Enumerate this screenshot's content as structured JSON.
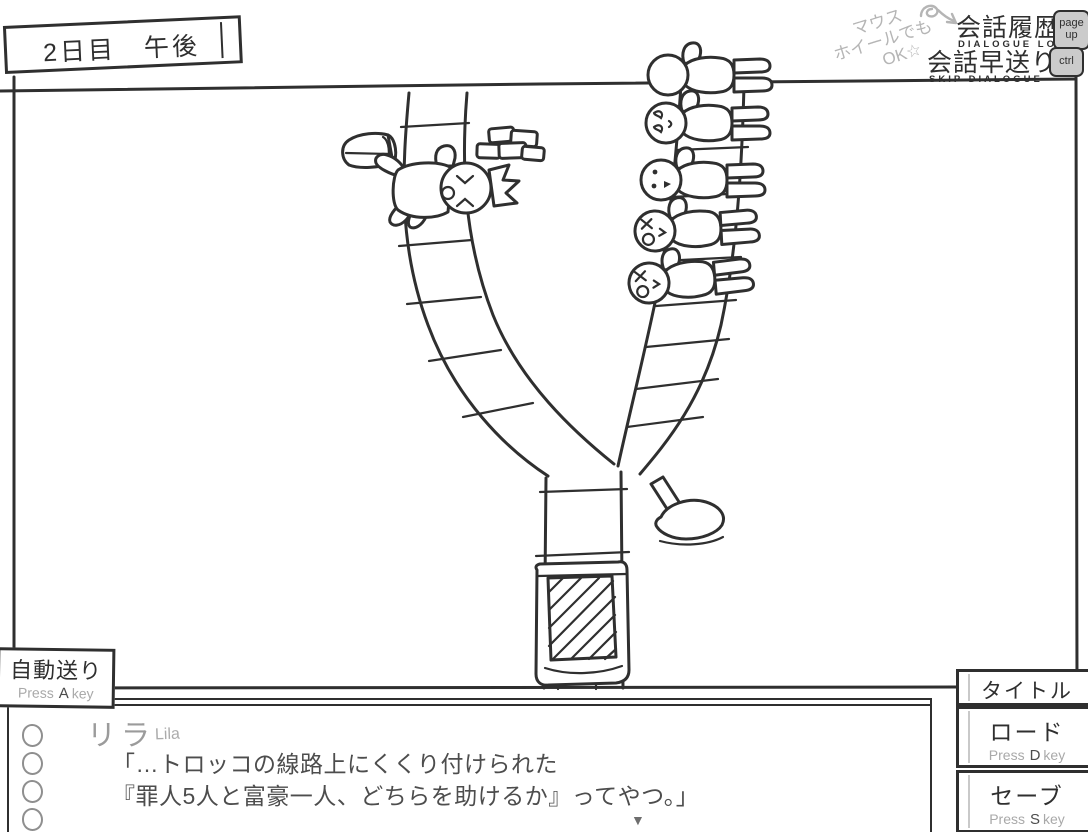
{
  "scene": {
    "banner": "2日目　午後",
    "advance_icon": "▼"
  },
  "shortcuts": {
    "note_lines": [
      "マウス",
      "ホイールでも",
      "OK☆"
    ],
    "log": {
      "label": "会話履歴",
      "sub": "DIALOGUE LOG",
      "key_line1": "page",
      "key_line2": "up"
    },
    "skip": {
      "label": "会話早送り",
      "sub": "SKIP DIALOGUE",
      "key": "ctrl"
    }
  },
  "auto_advance": {
    "label": "自動送り",
    "press_pre": "Press",
    "press_key": "A",
    "press_post": "key"
  },
  "menu": {
    "title": {
      "label": "タイトル"
    },
    "load": {
      "label": "ロード",
      "press_pre": "Press",
      "press_key": "D",
      "press_post": "key"
    },
    "save": {
      "label": "セーブ",
      "press_pre": "Press",
      "press_key": "S",
      "press_post": "key"
    }
  },
  "dialogue": {
    "speaker": "リラ",
    "speaker_en": "Lila",
    "lines": [
      "「…トロッコの線路上にくくり付けられた",
      "『罪人5人と富豪一人、どちらを助けるか』ってやつ。」"
    ]
  },
  "illustration": {
    "description_icons": [
      "trolley-icon",
      "switch-lever-icon",
      "treasure-chest-icon",
      "gold-bars-icon",
      "rich-person-icon",
      "five-sinners-icon"
    ]
  },
  "colors": {
    "ink": "#2f2f2f",
    "gray_text": "#9e9e9e",
    "note_gray": "#b5b5b5",
    "key_bg": "#cbcbcb"
  }
}
